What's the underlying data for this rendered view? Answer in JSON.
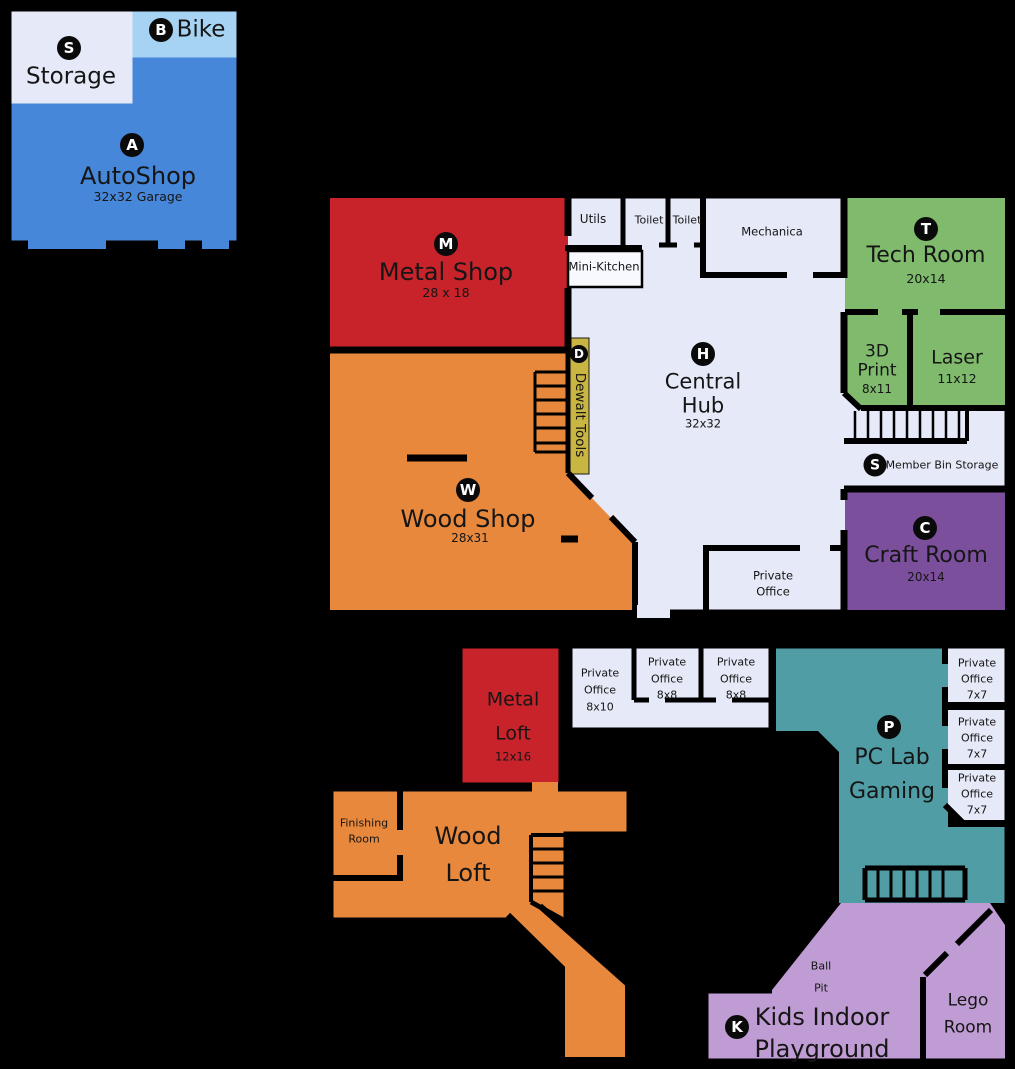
{
  "palette": {
    "autoshop_blue": "#4787D9",
    "bike_blue": "#A6D3F3",
    "floor_lavender": "#E6E9F7",
    "metal_red": "#C8232A",
    "wood_orange": "#E8883D",
    "dewalt_yellow": "#C9B542",
    "tech_green": "#7FBA6D",
    "craft_purple": "#7C4F9D",
    "pc_teal": "#519DA5",
    "kids_plum": "#BF9CD3",
    "kitchen_white": "#F8F9FE",
    "wall_black": "#000000"
  },
  "autoshop_building": {
    "storage": {
      "badge": "S",
      "label": "Storage"
    },
    "bike": {
      "badge": "B",
      "label": "Bike"
    },
    "autoshop": {
      "badge": "A",
      "label": "AutoShop",
      "size": "32x32 Garage"
    }
  },
  "main_building": {
    "metal_shop": {
      "badge": "M",
      "label": "Metal Shop",
      "size": "28 x 18"
    },
    "wood_shop": {
      "badge": "W",
      "label": "Wood Shop",
      "size": "28x31"
    },
    "dewalt_tools": {
      "badge": "D",
      "label": "Dewalt Tools"
    },
    "central_hub": {
      "badge": "H",
      "label_line1": "Central",
      "label_line2": "Hub",
      "size": "32x32"
    },
    "utils": {
      "label": "Utils"
    },
    "toilet_1": {
      "label": "Toilet"
    },
    "toilet_2": {
      "label": "Toilet"
    },
    "mechanica": {
      "label": "Mechanica"
    },
    "mini_kitchen": {
      "label": "Mini-Kitchen"
    },
    "tech_room": {
      "badge": "T",
      "label": "Tech Room",
      "size": "20x14"
    },
    "print_3d": {
      "label_line1": "3D",
      "label_line2": "Print",
      "size": "8x11"
    },
    "laser": {
      "label": "Laser",
      "size": "11x12"
    },
    "member_bin_storage": {
      "badge": "S",
      "label": "Member Bin Storage"
    },
    "craft_room": {
      "badge": "C",
      "label": "Craft Room",
      "size": "20x14"
    },
    "private_office": {
      "label_line1": "Private",
      "label_line2": "Office"
    }
  },
  "lower_building": {
    "metal_loft": {
      "label_line1": "Metal",
      "label_line2": "Loft",
      "size": "12x16"
    },
    "offices": [
      {
        "label_line1": "Private",
        "label_line2": "Office",
        "size": "8x10"
      },
      {
        "label_line1": "Private",
        "label_line2": "Office",
        "size": "8x8"
      },
      {
        "label_line1": "Private",
        "label_line2": "Office",
        "size": "8x8"
      }
    ],
    "pc_lab": {
      "badge": "P",
      "label_line1": "PC Lab",
      "label_line2": "Gaming"
    },
    "side_offices": [
      {
        "label_line1": "Private",
        "label_line2": "Office",
        "size": "7x7"
      },
      {
        "label_line1": "Private",
        "label_line2": "Office",
        "size": "7x7"
      },
      {
        "label_line1": "Private",
        "label_line2": "Office",
        "size": "7x7"
      }
    ],
    "wood_loft": {
      "label_line1": "Wood",
      "label_line2": "Loft"
    },
    "finishing_room": {
      "label_line1": "Finishing",
      "label_line2": "Room"
    },
    "kids_playground": {
      "badge": "K",
      "label_line1": "Kids Indoor",
      "label_line2": "Playground"
    },
    "ball_pit": {
      "label_line1": "Ball",
      "label_line2": "Pit"
    },
    "lego_room": {
      "label_line1": "Lego",
      "label_line2": "Room"
    }
  }
}
